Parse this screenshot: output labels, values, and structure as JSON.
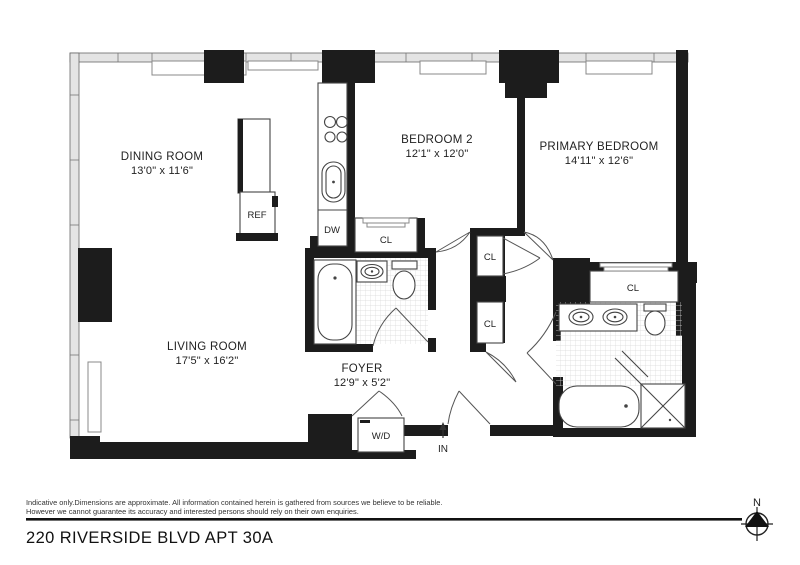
{
  "plan": {
    "rooms": {
      "dining": {
        "name": "DINING ROOM",
        "dims": "13'0\" x 11'6\""
      },
      "bedroom2": {
        "name": "BEDROOM 2",
        "dims": "12'1\" x 12'0\""
      },
      "primary": {
        "name": "PRIMARY BEDROOM",
        "dims": "14'11\" x 12'6\""
      },
      "living": {
        "name": "LIVING ROOM",
        "dims": "17'5\" x 16'2\""
      },
      "foyer": {
        "name": "FOYER",
        "dims": "12'9\" x 5'2\""
      }
    },
    "fixtures": {
      "refrigerator": "REF",
      "dishwasher": "DW",
      "washer_dryer": "W/D",
      "closet": "CL"
    },
    "entry": {
      "in_label": "IN"
    },
    "compass": {
      "north": "N"
    }
  },
  "footer": {
    "disclaimer_line1": "Indicative only.Dimensions are approximate. All information contained herein is gathered from sources we believe to be reliable.",
    "disclaimer_line2": "However we cannot guarantee its accuracy and interested persons should rely on their own enquiries.",
    "address": "220 RIVERSIDE BLVD APT 30A"
  },
  "colors": {
    "wall": "#1c1c1c",
    "window_band": "#e4e4e4",
    "text": "#222222"
  }
}
